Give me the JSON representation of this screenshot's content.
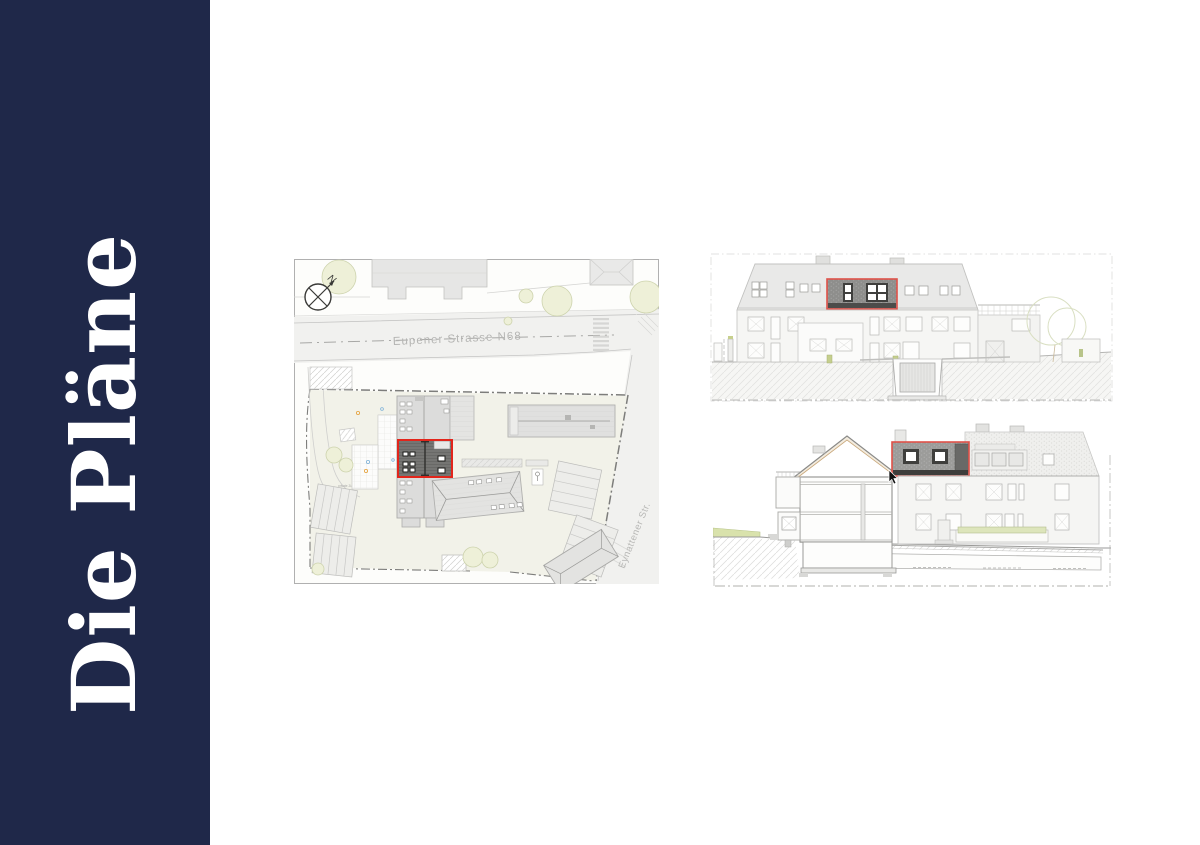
{
  "page": {
    "background": "#ffffff"
  },
  "sidebar": {
    "title": "Die Pläne",
    "background": "#1f2849",
    "text_color": "#ffffff"
  },
  "site_plan": {
    "compass_label": "N",
    "street_main_label": "Eupener Strasse N68",
    "street_side_label": "Eynattener Str.",
    "driveway_label": "private Zufahrt Tiefgarage",
    "highlight_color": "#e2251b"
  },
  "elevations": {
    "highlight_color": "#df5149"
  },
  "icons": {
    "compass_icon": "circle-with-cross-and-north-arrow",
    "cursor_icon": "mouse-pointer-arrow"
  }
}
